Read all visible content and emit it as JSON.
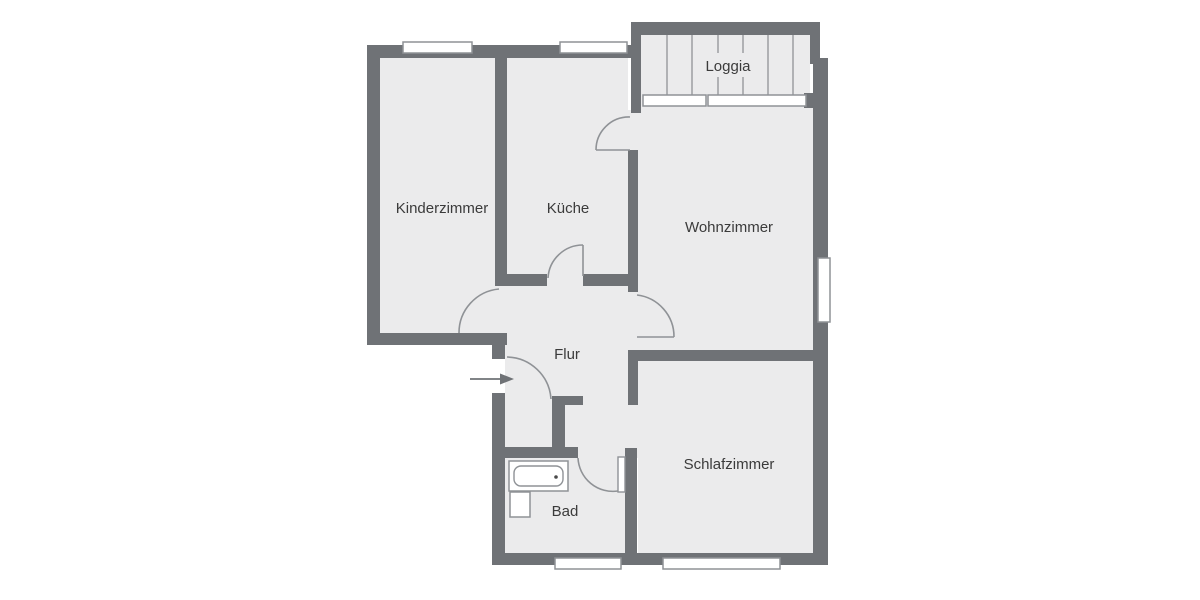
{
  "colors": {
    "wall": "#6f7276",
    "floor": "#ebebec",
    "outline": "#8f9296",
    "label": "#3b3b3b",
    "window_fill": "#ffffff",
    "background": "#ffffff"
  },
  "rooms": {
    "kinderzimmer": {
      "label": "Kinderzimmer"
    },
    "kueche": {
      "label": "Küche"
    },
    "wohnzimmer": {
      "label": "Wohnzimmer"
    },
    "loggia": {
      "label": "Loggia"
    },
    "flur": {
      "label": "Flur"
    },
    "bad": {
      "label": "Bad"
    },
    "schlafzimmer": {
      "label": "Schlafzimmer"
    }
  },
  "fixtures": [
    "bathtub",
    "washbasin",
    "entrance-arrow"
  ],
  "window_count": 7,
  "door_count": 6
}
